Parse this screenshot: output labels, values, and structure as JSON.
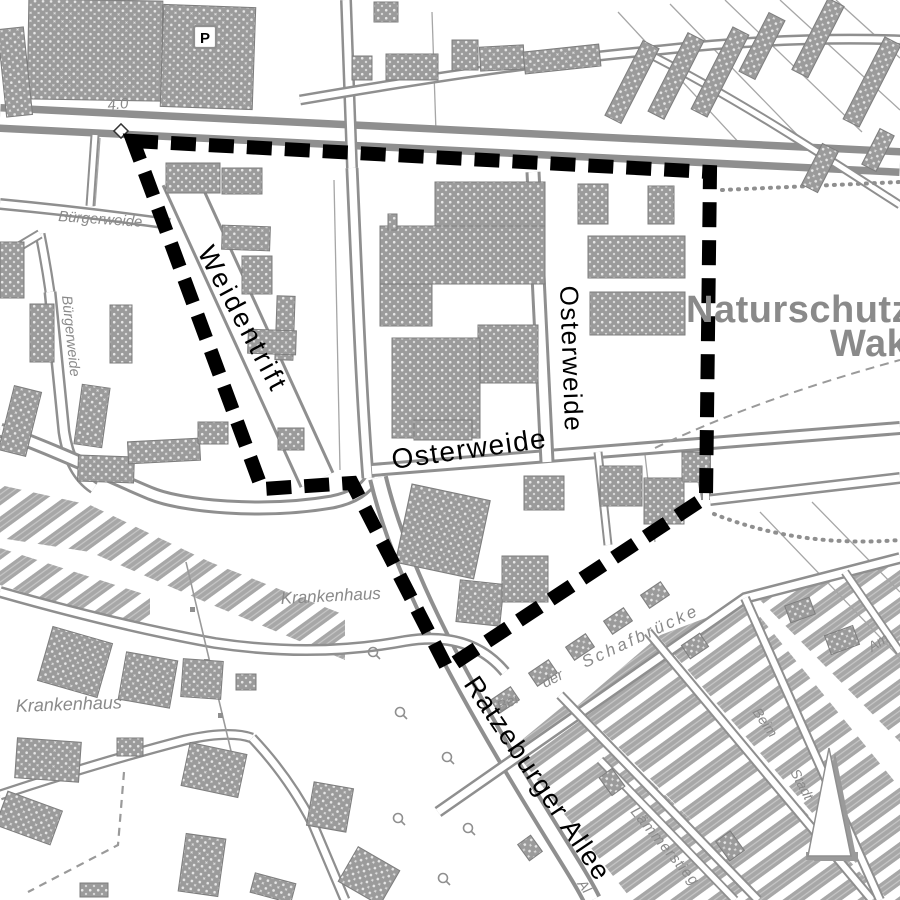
{
  "map": {
    "type": "city-plan-area-map",
    "labels": {
      "weidentrift": "Weidentrift",
      "osterweide_horizontal": "Osterweide",
      "osterweide_vertical": "Osterweide",
      "ratzeburger_allee": "Ratzeburger Allee",
      "naturschutz_line1": "Naturschutzg",
      "naturschutz_line2": "Wak",
      "buergerweide_top": "Bürgerweide",
      "buergerweide_left": "Bürgerweide",
      "krankenhaus_mid": "Krankenhaus",
      "krankenhaus_bottom": "Krankenhaus",
      "bei": "Bei",
      "der": "der",
      "schafbruecke": "Schafbrücke",
      "laemmerstieg": "Lämmerstieg",
      "beim": "Beim",
      "stadt": "Stadt",
      "am": "Am",
      "allee_fragment": "Al",
      "parking": "P",
      "elevation_marker": "4.0"
    },
    "colors": {
      "background": "#ffffff",
      "roads": "#8f8f8f",
      "buildings": "#9b9b9b",
      "boundary": "#000000",
      "gray_labels": "#8a8a8a"
    },
    "boundary": {
      "style": "thick-black-dashed",
      "vertices_px": [
        [
          133,
          141
        ],
        [
          710,
          172
        ],
        [
          706,
          497
        ],
        [
          447,
          668
        ],
        [
          352,
          483
        ],
        [
          262,
          489
        ]
      ]
    },
    "north_arrow_position": "bottom-right"
  }
}
